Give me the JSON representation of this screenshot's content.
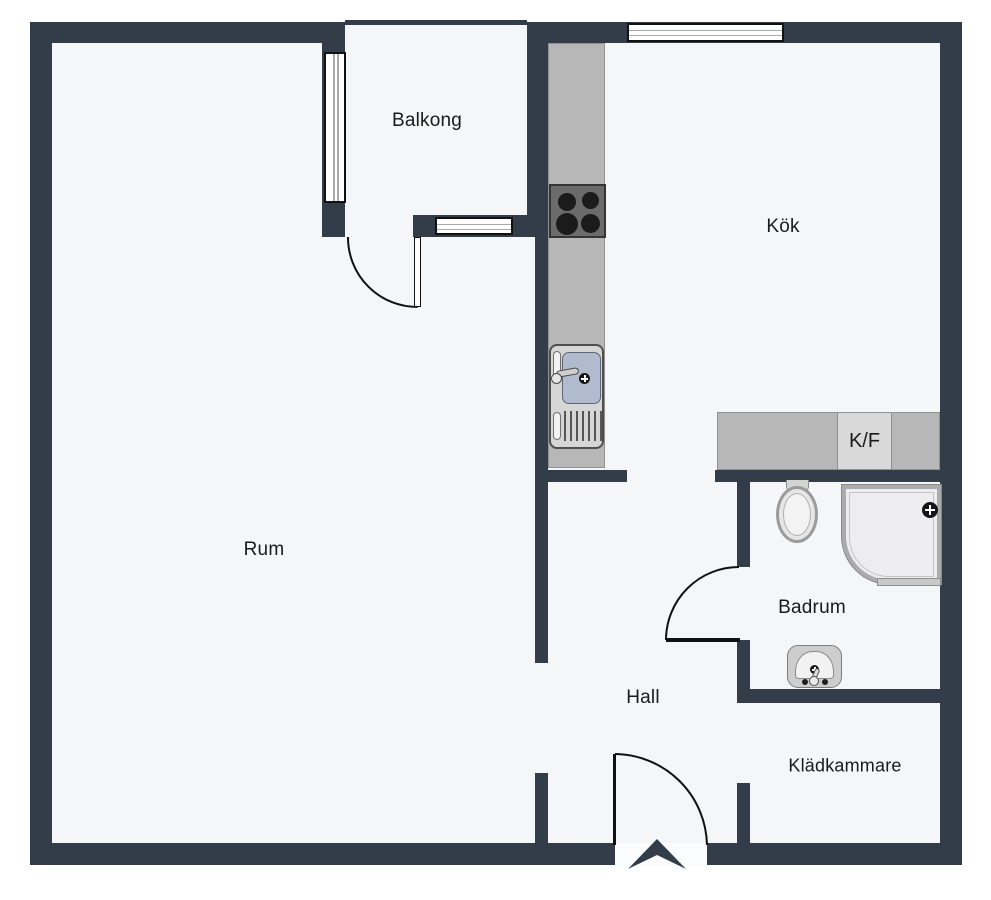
{
  "plan": {
    "type": "apartment-floor-plan",
    "rooms": [
      {
        "id": "rum",
        "label": "Rum"
      },
      {
        "id": "kok",
        "label": "Kök"
      },
      {
        "id": "balkong",
        "label": "Balkong"
      },
      {
        "id": "badrum",
        "label": "Badrum"
      },
      {
        "id": "hall",
        "label": "Hall"
      },
      {
        "id": "kladkammare",
        "label": "Klädkammare"
      }
    ],
    "fixtures": {
      "kf_label": "K/F",
      "icons": [
        "stove-icon",
        "kitchen-sink-icon",
        "fridge-freezer-unit",
        "toilet-icon",
        "shower-icon",
        "bathroom-sink-icon",
        "entrance-arrow-icon",
        "window-icon",
        "door-swing-arc"
      ]
    },
    "colors": {
      "wall": "#333d4a",
      "floor": "#f5f6f8",
      "page_bg": "#ffffff",
      "line": "#111111",
      "counter": "#b7b7b7",
      "counter_light": "#d9d9d9",
      "stove": "#6b6b6b",
      "sink_bowl": "#b1bbce",
      "fixture_light": "#ededef",
      "text": "#1a1a1c"
    }
  }
}
